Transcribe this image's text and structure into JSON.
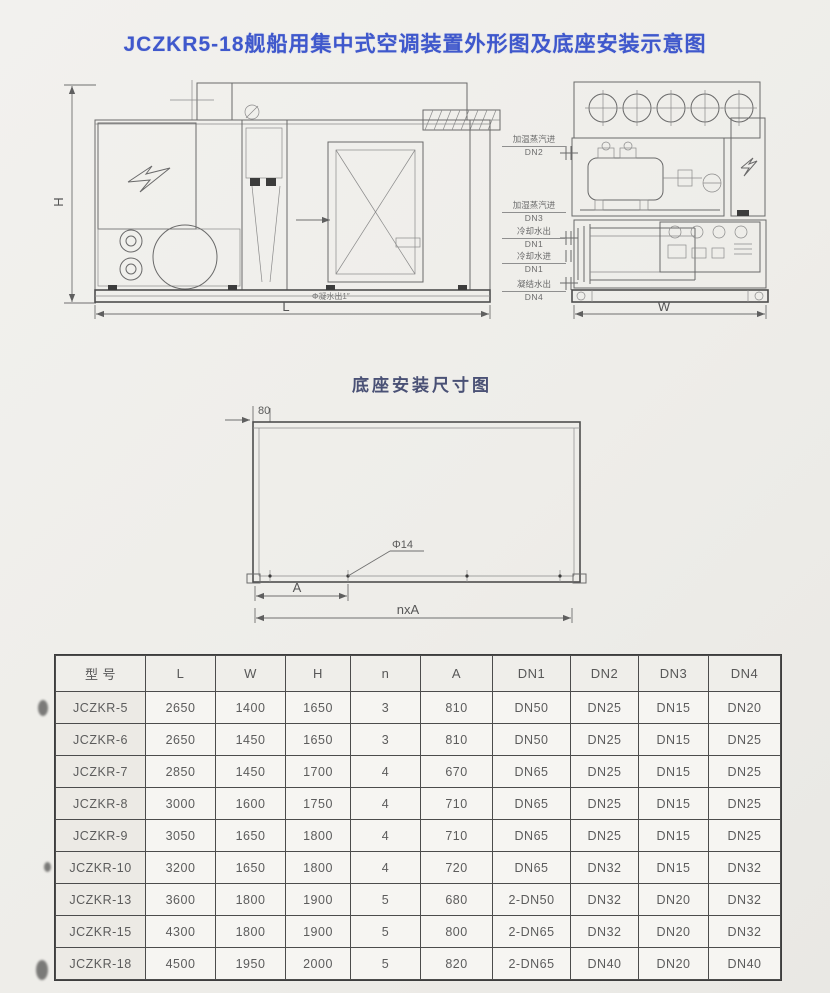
{
  "page": {
    "title": "JCZKR5-18舰船用集中式空调装置外形图及底座安装示意图"
  },
  "side_view": {
    "dim_h": "H",
    "dim_l": "L",
    "drain_label": "Φ凝水出1″"
  },
  "end_view": {
    "dim_w": "W",
    "ports": [
      {
        "name": "加温蒸汽进",
        "dn": "DN2"
      },
      {
        "name": "加湿蒸汽进",
        "dn": "DN3"
      },
      {
        "name": "冷却水出",
        "dn": "DN1"
      },
      {
        "name": "冷却水进",
        "dn": "DN1"
      },
      {
        "name": "凝结水出",
        "dn": "DN4"
      }
    ]
  },
  "base_diagram": {
    "caption": "底座安装尺寸图",
    "edge_offset": "80",
    "hole_label": "Φ14",
    "dim_a": "A",
    "dim_nxa": "nxA"
  },
  "table": {
    "headers": [
      "型 号",
      "L",
      "W",
      "H",
      "n",
      "A",
      "DN1",
      "DN2",
      "DN3",
      "DN4"
    ],
    "rows": [
      [
        "JCZKR-5",
        "2650",
        "1400",
        "1650",
        "3",
        "810",
        "DN50",
        "DN25",
        "DN15",
        "DN20"
      ],
      [
        "JCZKR-6",
        "2650",
        "1450",
        "1650",
        "3",
        "810",
        "DN50",
        "DN25",
        "DN15",
        "DN25"
      ],
      [
        "JCZKR-7",
        "2850",
        "1450",
        "1700",
        "4",
        "670",
        "DN65",
        "DN25",
        "DN15",
        "DN25"
      ],
      [
        "JCZKR-8",
        "3000",
        "1600",
        "1750",
        "4",
        "710",
        "DN65",
        "DN25",
        "DN15",
        "DN25"
      ],
      [
        "JCZKR-9",
        "3050",
        "1650",
        "1800",
        "4",
        "710",
        "DN65",
        "DN25",
        "DN15",
        "DN25"
      ],
      [
        "JCZKR-10",
        "3200",
        "1650",
        "1800",
        "4",
        "720",
        "DN65",
        "DN32",
        "DN15",
        "DN32"
      ],
      [
        "JCZKR-13",
        "3600",
        "1800",
        "1900",
        "5",
        "680",
        "2-DN50",
        "DN32",
        "DN20",
        "DN32"
      ],
      [
        "JCZKR-15",
        "4300",
        "1800",
        "1900",
        "5",
        "800",
        "2-DN65",
        "DN32",
        "DN20",
        "DN32"
      ],
      [
        "JCZKR-18",
        "4500",
        "1950",
        "2000",
        "5",
        "820",
        "2-DN65",
        "DN40",
        "DN20",
        "DN40"
      ]
    ]
  }
}
